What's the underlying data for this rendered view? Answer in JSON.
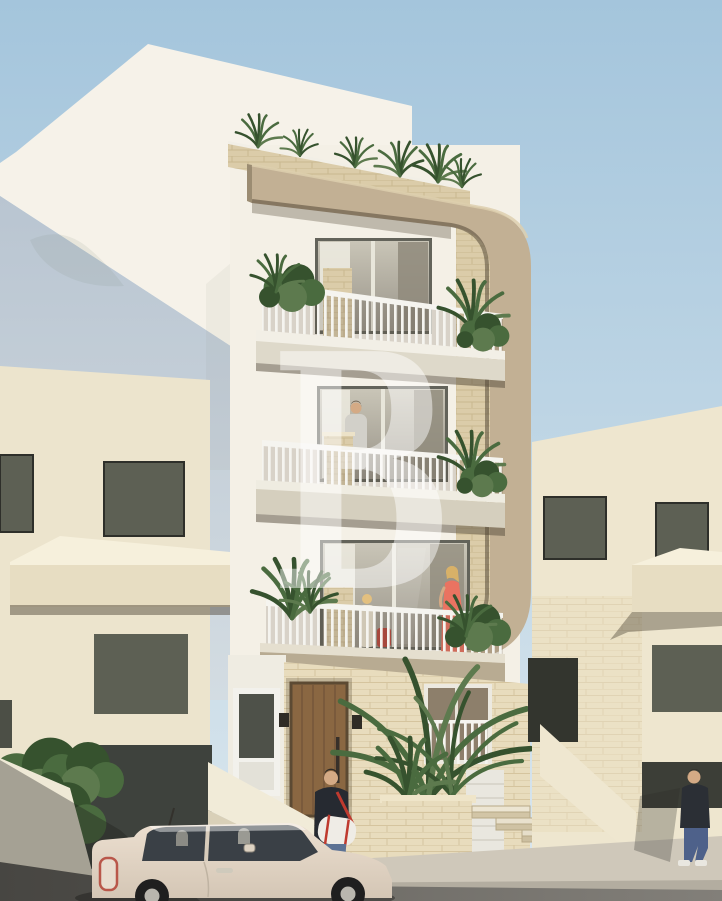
{
  "meta": {
    "description": "Photorealistic architectural render of a new four-storey apartment block with a rounded beige feature frame, three balconies with residents, street-level entrance, parked Fiat 500 and pedestrians, flanked by neighbouring cream townhouses under a clear sky.",
    "watermark_present": true
  },
  "watermark": {
    "letter": "B",
    "color": "rgba(255,255,255,0.48)"
  },
  "palette": {
    "sky_top": "#a4c5dc",
    "sky_bottom": "#dbe7ee",
    "white_building": "#f6f2e9",
    "white_building_shadow": "#b9c5d1",
    "facade": "#f4f0e6",
    "frame": "#c2b094",
    "frame_shadow": "#8a7a63",
    "limestone": "#e8dcbd",
    "limestone_trim": "#dbcca9",
    "neighbor_left": "#ece4cd",
    "neighbor_right": "#eee6cf",
    "window_dark": "#5d6054",
    "railing": "#f5f4ef",
    "wood_door": "#8a6742",
    "plant": "#4a6b3f",
    "plant_dark": "#36522e",
    "car_body": "#ecdfd0",
    "car_glass": "#3a4046",
    "sidewalk": "#cfc8ba",
    "road": "#827f79",
    "dress": "#ea7361",
    "jacket": "#262a31",
    "jeans": "#5c7294",
    "hoodie": "#2b2f35",
    "skin": "#d4aa85",
    "dark_court": "#3e423d"
  }
}
